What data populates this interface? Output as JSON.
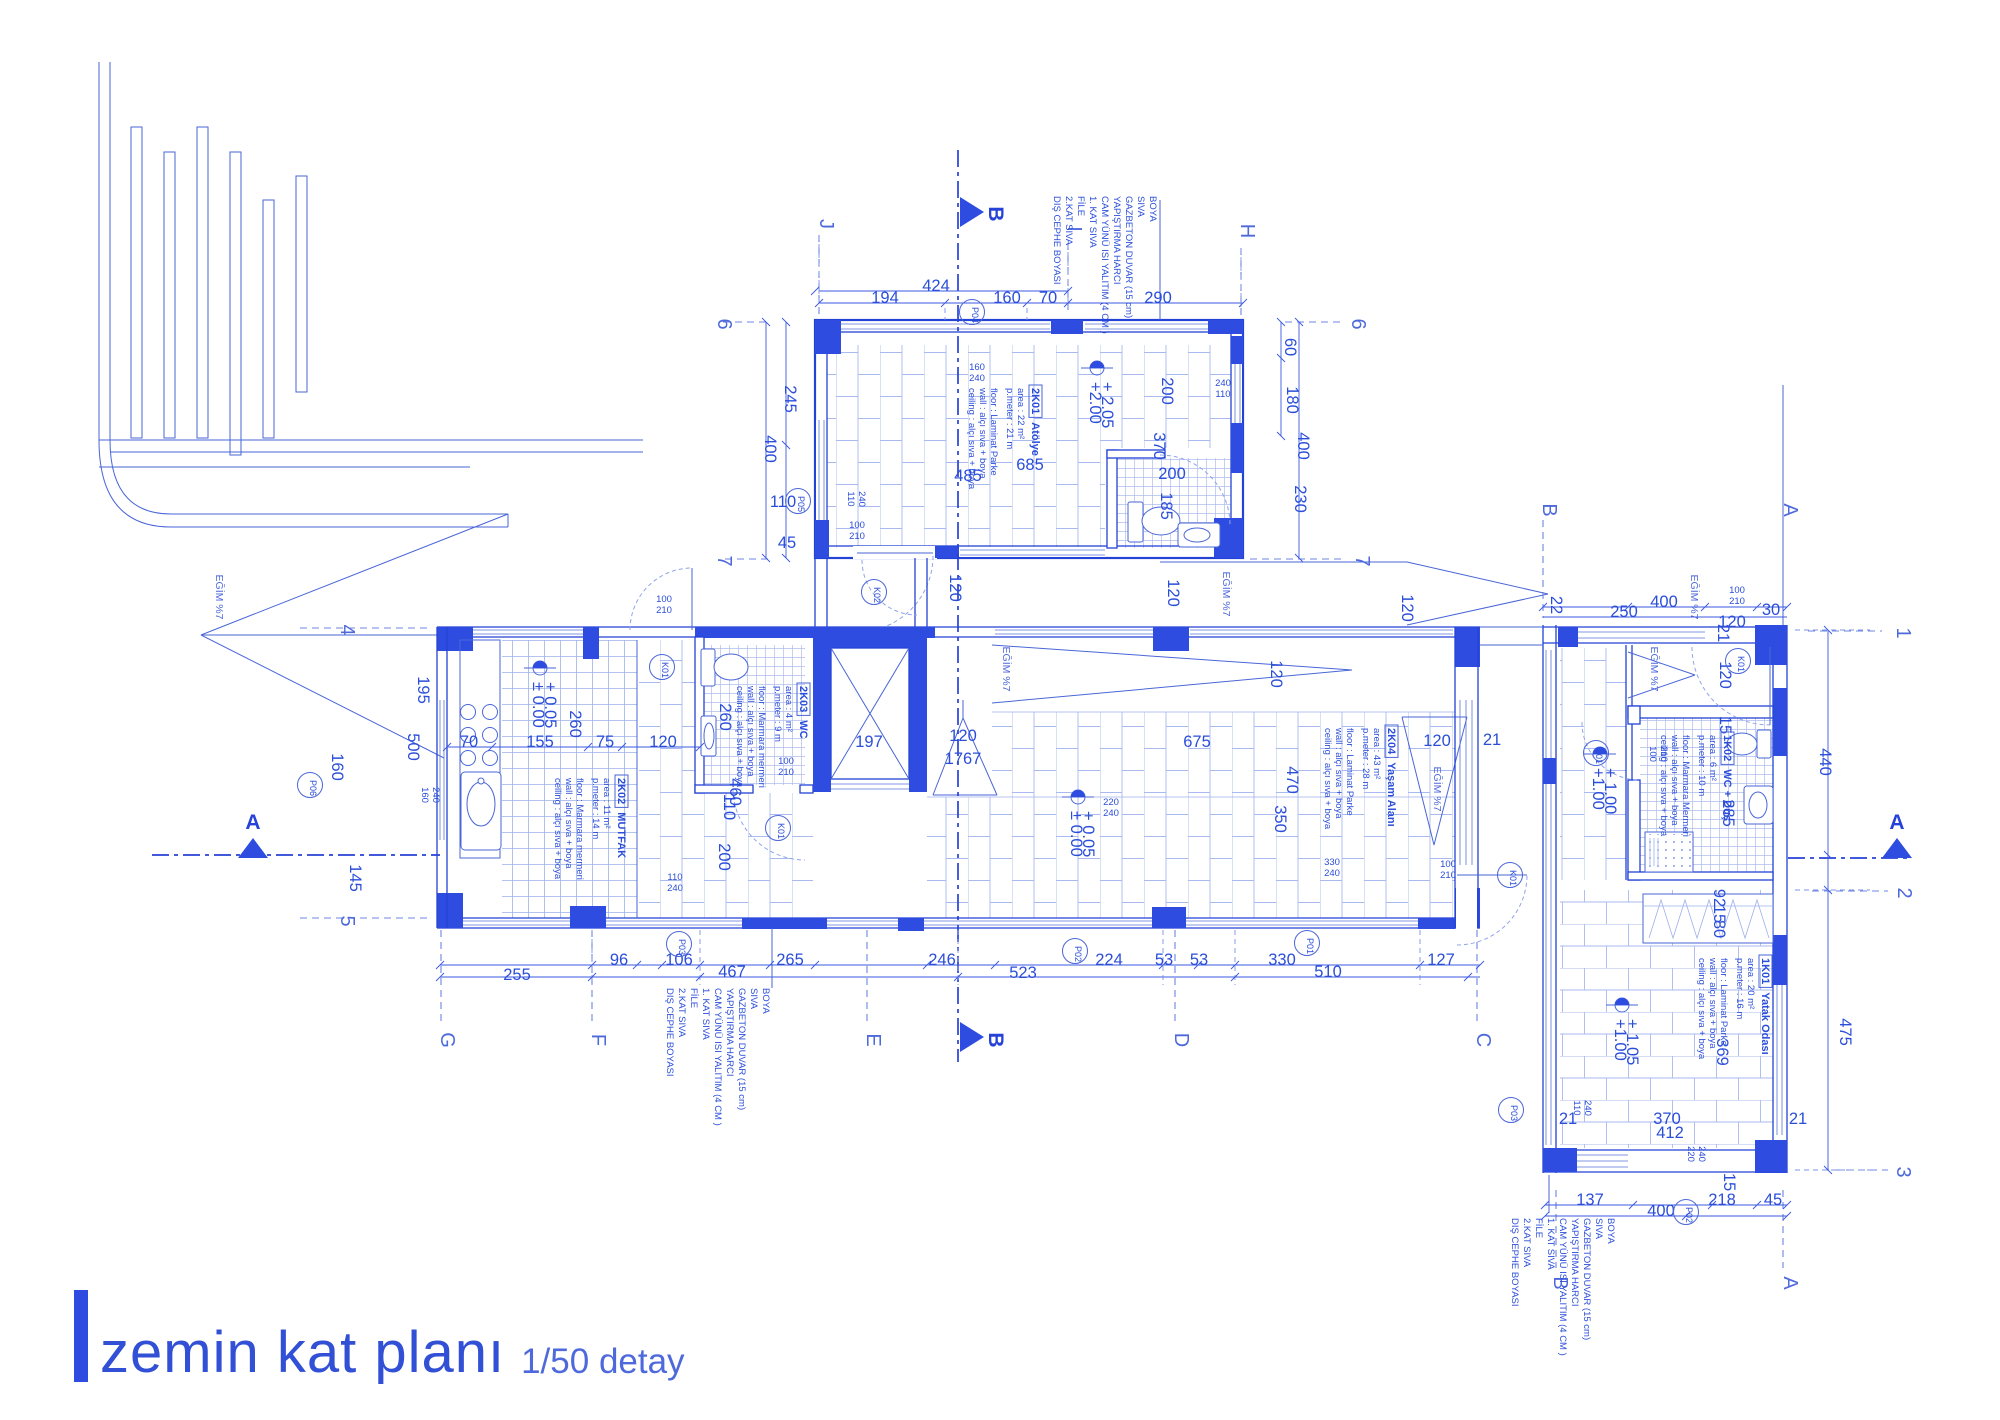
{
  "title": {
    "main": "zemin kat planı",
    "scale": "1/50 detay"
  },
  "colors": {
    "ink": "#2b4ed9",
    "wall": "#2442d6",
    "column": "#2e4de0",
    "light": "#9db0ec"
  },
  "note_lines": [
    "BOYA",
    "SIVA",
    "GAZBETON DUVAR (15 cm)",
    "YAPIŞTIRMA HARCI",
    "CAM YÜNÜ ISI YALITIM (4 CM )",
    "1. KAT SIVA",
    "FİLE",
    "2.KAT SIVA",
    "DIŞ CEPHE BOYASI"
  ],
  "notes": [
    {
      "x": 1150,
      "y": 196
    },
    {
      "x": 763,
      "y": 988
    },
    {
      "x": 1608,
      "y": 1218
    }
  ],
  "rooms": [
    {
      "code": "2K01",
      "name": "Atölye",
      "x": 1032,
      "y": 388,
      "lines": [
        "area : 22 m²",
        "p.meter : 21 m",
        "floor : Laminat Parke",
        "wall : alçı sıva + boya",
        "ceiling : alçı sıva + boya"
      ]
    },
    {
      "code": "2K02",
      "name": "MUTFAK",
      "x": 618,
      "y": 778,
      "lines": [
        "area : 11 m²",
        "p.meter : 14 m",
        "floor : Marmara mermeri",
        "wall : alçı sıva + boya",
        "ceiling : alçı sıva + boya"
      ]
    },
    {
      "code": "2K03",
      "name": "WC",
      "x": 800,
      "y": 686,
      "lines": [
        "area : 4 m²",
        "p.meter : 9 m",
        "floor : Marmara mermeri",
        "wall : alçı sıva + boya",
        "ceiling : alçı sıva + boya"
      ]
    },
    {
      "code": "2K04",
      "name": "Yaşam Alanı",
      "x": 1388,
      "y": 728,
      "lines": [
        "area : 43 m²",
        "p.meter : 28 m",
        "floor : Laminat Parke",
        "wall : alçı sıva + boya",
        "ceiling : alçı sıva + boya"
      ]
    },
    {
      "code": "1K02",
      "name": "WC + Duş",
      "x": 1724,
      "y": 735,
      "lines": [
        "area : 6 m²",
        "p.meter : 10 m",
        "floor : Marmara Mermeri",
        "wall : alçı sıva + boya",
        "ceiling : alçı sıva + boya"
      ]
    },
    {
      "code": "1K01",
      "name": "Yatak Odası",
      "x": 1762,
      "y": 958,
      "lines": [
        "area : 20 m²",
        "p.meter : 16 m",
        "floor : Laminat Parke",
        "wall : alçı sıva + boya",
        "ceiling : alçı sıva + boya"
      ]
    }
  ],
  "tags": [
    {
      "t": "P04",
      "x": 972,
      "y": 312
    },
    {
      "t": "P05",
      "x": 798,
      "y": 501
    },
    {
      "t": "K02",
      "x": 874,
      "y": 592
    },
    {
      "t": "K01",
      "x": 662,
      "y": 667
    },
    {
      "t": "K01",
      "x": 778,
      "y": 828
    },
    {
      "t": "P06",
      "x": 310,
      "y": 785
    },
    {
      "t": "P03",
      "x": 679,
      "y": 944
    },
    {
      "t": "P02",
      "x": 1075,
      "y": 951
    },
    {
      "t": "P01",
      "x": 1307,
      "y": 943
    },
    {
      "t": "K01",
      "x": 1510,
      "y": 875
    },
    {
      "t": "K01",
      "x": 1738,
      "y": 661
    },
    {
      "t": "K01",
      "x": 1596,
      "y": 753
    },
    {
      "t": "P03",
      "x": 1511,
      "y": 1110
    },
    {
      "t": "P02",
      "x": 1686,
      "y": 1212
    }
  ],
  "elevations": [
    {
      "x": 1097,
      "y": 368,
      "l1": "+ 2.05",
      "l2": "+2.00"
    },
    {
      "x": 540,
      "y": 668,
      "l1": "+ 0.05",
      "l2": "± 0.00"
    },
    {
      "x": 1078,
      "y": 797,
      "l1": "+ 0.05",
      "l2": "± 0.00"
    },
    {
      "x": 1600,
      "y": 754,
      "l1": "+ 1.00",
      "l2": "+1.00"
    },
    {
      "x": 1622,
      "y": 1005,
      "l1": "+ 1.05",
      "l2": "+1.00"
    }
  ],
  "labels": [
    {
      "t": "424",
      "x": 936,
      "y": 291
    },
    {
      "t": "194",
      "x": 885,
      "y": 303
    },
    {
      "t": "160",
      "x": 1007,
      "y": 303
    },
    {
      "t": "70",
      "x": 1048,
      "y": 303
    },
    {
      "t": "290",
      "x": 1158,
      "y": 303
    },
    {
      "t": "485",
      "x": 968,
      "y": 481
    },
    {
      "t": "685",
      "x": 1030,
      "y": 470
    },
    {
      "t": "200",
      "x": 1162,
      "y": 391,
      "r": 1
    },
    {
      "t": "370",
      "x": 1154,
      "y": 446,
      "r": 1
    },
    {
      "t": "200",
      "x": 1172,
      "y": 479
    },
    {
      "t": "185",
      "x": 1161,
      "y": 506,
      "r": 1
    },
    {
      "t": "245",
      "x": 785,
      "y": 399,
      "r": 1
    },
    {
      "t": "400",
      "x": 765,
      "y": 449,
      "r": 1
    },
    {
      "t": "110",
      "x": 783,
      "y": 507
    },
    {
      "t": "45",
      "x": 787,
      "y": 548
    },
    {
      "t": "60",
      "x": 1285,
      "y": 347,
      "r": 1
    },
    {
      "t": "180",
      "x": 1287,
      "y": 400,
      "r": 1
    },
    {
      "t": "400",
      "x": 1298,
      "y": 446,
      "r": 1
    },
    {
      "t": "230",
      "x": 1295,
      "y": 499,
      "r": 1
    },
    {
      "t": "120",
      "x": 950,
      "y": 588,
      "r": 1
    },
    {
      "t": "120",
      "x": 1168,
      "y": 593,
      "r": 1
    },
    {
      "t": "120",
      "x": 1402,
      "y": 608,
      "r": 1
    },
    {
      "t": "195",
      "x": 418,
      "y": 690,
      "r": 1
    },
    {
      "t": "500",
      "x": 408,
      "y": 747,
      "r": 1
    },
    {
      "t": "160",
      "x": 332,
      "y": 767,
      "r": 1
    },
    {
      "t": "145",
      "x": 350,
      "y": 878,
      "r": 1
    },
    {
      "t": "70",
      "x": 469,
      "y": 747
    },
    {
      "t": "155",
      "x": 540,
      "y": 747
    },
    {
      "t": "75",
      "x": 605,
      "y": 747
    },
    {
      "t": "120",
      "x": 663,
      "y": 747
    },
    {
      "t": "260",
      "x": 570,
      "y": 724,
      "r": 1
    },
    {
      "t": "260",
      "x": 720,
      "y": 717,
      "r": 1
    },
    {
      "t": "460",
      "x": 730,
      "y": 792,
      "r": 1
    },
    {
      "t": "110",
      "x": 724,
      "y": 807,
      "r": 1
    },
    {
      "t": "200",
      "x": 719,
      "y": 857,
      "r": 1
    },
    {
      "t": "197",
      "x": 869,
      "y": 747
    },
    {
      "t": "120",
      "x": 963,
      "y": 741
    },
    {
      "t": "1767",
      "x": 963,
      "y": 764
    },
    {
      "t": "675",
      "x": 1197,
      "y": 747
    },
    {
      "t": "120",
      "x": 1271,
      "y": 674,
      "r": 1
    },
    {
      "t": "470",
      "x": 1287,
      "y": 780,
      "r": 1
    },
    {
      "t": "350",
      "x": 1275,
      "y": 819,
      "r": 1
    },
    {
      "t": "120",
      "x": 1437,
      "y": 746
    },
    {
      "t": "21",
      "x": 1492,
      "y": 745
    },
    {
      "t": "255",
      "x": 517,
      "y": 980
    },
    {
      "t": "96",
      "x": 619,
      "y": 965
    },
    {
      "t": "106",
      "x": 679,
      "y": 965
    },
    {
      "t": "467",
      "x": 732,
      "y": 977
    },
    {
      "t": "265",
      "x": 790,
      "y": 965
    },
    {
      "t": "246",
      "x": 942,
      "y": 965
    },
    {
      "t": "523",
      "x": 1023,
      "y": 978
    },
    {
      "t": "224",
      "x": 1109,
      "y": 965
    },
    {
      "t": "53",
      "x": 1164,
      "y": 965
    },
    {
      "t": "53",
      "x": 1199,
      "y": 965
    },
    {
      "t": "330",
      "x": 1282,
      "y": 965
    },
    {
      "t": "510",
      "x": 1328,
      "y": 977
    },
    {
      "t": "127",
      "x": 1441,
      "y": 965
    },
    {
      "t": "400",
      "x": 1664,
      "y": 607
    },
    {
      "t": "250",
      "x": 1624,
      "y": 617
    },
    {
      "t": "120",
      "x": 1732,
      "y": 627
    },
    {
      "t": "30",
      "x": 1771,
      "y": 615
    },
    {
      "t": "22",
      "x": 1551,
      "y": 605,
      "r": 1,
      "fs": 13
    },
    {
      "t": "21",
      "x": 1718,
      "y": 633,
      "r": 1,
      "fs": 13
    },
    {
      "t": "120",
      "x": 1720,
      "y": 675,
      "r": 1
    },
    {
      "t": "15",
      "x": 1720,
      "y": 725,
      "r": 1,
      "fs": 13
    },
    {
      "t": "285",
      "x": 1723,
      "y": 813,
      "r": 1
    },
    {
      "t": "92",
      "x": 1714,
      "y": 898,
      "r": 1,
      "fs": 12
    },
    {
      "t": "15",
      "x": 1714,
      "y": 914,
      "r": 1,
      "fs": 12
    },
    {
      "t": "80",
      "x": 1714,
      "y": 929,
      "r": 1,
      "fs": 12
    },
    {
      "t": "369",
      "x": 1717,
      "y": 1052,
      "r": 1
    },
    {
      "t": "370",
      "x": 1667,
      "y": 1124
    },
    {
      "t": "412",
      "x": 1670,
      "y": 1138
    },
    {
      "t": "21",
      "x": 1798,
      "y": 1124,
      "fs": 13
    },
    {
      "t": "21",
      "x": 1568,
      "y": 1124,
      "fs": 13
    },
    {
      "t": "137",
      "x": 1590,
      "y": 1205
    },
    {
      "t": "400",
      "x": 1661,
      "y": 1216
    },
    {
      "t": "218",
      "x": 1722,
      "y": 1205
    },
    {
      "t": "45",
      "x": 1773,
      "y": 1205
    },
    {
      "t": "15",
      "x": 1724,
      "y": 1182,
      "r": 1,
      "fs": 13
    },
    {
      "t": "440",
      "x": 1820,
      "y": 762,
      "r": 1
    },
    {
      "t": "475",
      "x": 1840,
      "y": 1032,
      "r": 1
    },
    {
      "t": "100",
      "x": 857,
      "y": 528,
      "c": "s"
    },
    {
      "t": "210",
      "x": 857,
      "y": 539,
      "c": "s"
    },
    {
      "t": "100",
      "x": 664,
      "y": 602,
      "c": "s"
    },
    {
      "t": "210",
      "x": 664,
      "y": 613,
      "c": "s"
    },
    {
      "t": "100",
      "x": 786,
      "y": 764,
      "c": "s"
    },
    {
      "t": "210",
      "x": 786,
      "y": 775,
      "c": "s"
    },
    {
      "t": "100",
      "x": 1448,
      "y": 867,
      "c": "s"
    },
    {
      "t": "210",
      "x": 1448,
      "y": 878,
      "c": "s"
    },
    {
      "t": "100",
      "x": 1737,
      "y": 593,
      "c": "s"
    },
    {
      "t": "210",
      "x": 1737,
      "y": 604,
      "c": "s"
    },
    {
      "t": "100",
      "x": 1650,
      "y": 754,
      "c": "s",
      "r": 1
    },
    {
      "t": "210",
      "x": 1661,
      "y": 754,
      "c": "s",
      "r": 1
    },
    {
      "t": "160",
      "x": 977,
      "y": 370,
      "c": "s"
    },
    {
      "t": "240",
      "x": 977,
      "y": 381,
      "c": "s"
    },
    {
      "t": "110",
      "x": 848,
      "y": 499,
      "c": "s",
      "r": 1
    },
    {
      "t": "240",
      "x": 859,
      "y": 499,
      "c": "s",
      "r": 1
    },
    {
      "t": "240",
      "x": 1223,
      "y": 386,
      "c": "s"
    },
    {
      "t": "110",
      "x": 1223,
      "y": 397,
      "c": "s"
    },
    {
      "t": "160",
      "x": 422,
      "y": 795,
      "c": "s",
      "r": 1
    },
    {
      "t": "240",
      "x": 433,
      "y": 795,
      "c": "s",
      "r": 1
    },
    {
      "t": "110",
      "x": 675,
      "y": 880,
      "c": "s"
    },
    {
      "t": "240",
      "x": 675,
      "y": 891,
      "c": "s"
    },
    {
      "t": "220",
      "x": 1111,
      "y": 805,
      "c": "s"
    },
    {
      "t": "240",
      "x": 1111,
      "y": 816,
      "c": "s"
    },
    {
      "t": "330",
      "x": 1332,
      "y": 865,
      "c": "s"
    },
    {
      "t": "240",
      "x": 1332,
      "y": 876,
      "c": "s"
    },
    {
      "t": "110",
      "x": 1574,
      "y": 1108,
      "c": "s",
      "r": 1
    },
    {
      "t": "240",
      "x": 1585,
      "y": 1108,
      "c": "s",
      "r": 1
    },
    {
      "t": "220",
      "x": 1688,
      "y": 1154,
      "c": "s",
      "r": 1
    },
    {
      "t": "240",
      "x": 1699,
      "y": 1154,
      "c": "s",
      "r": 1
    },
    {
      "t": "EĞİM %7",
      "x": 216,
      "y": 597,
      "c": "e",
      "r": 1
    },
    {
      "t": "EĞİM %7",
      "x": 1003,
      "y": 669,
      "c": "e",
      "r": 1
    },
    {
      "t": "EĞİM %7",
      "x": 1223,
      "y": 594,
      "c": "e",
      "r": 1
    },
    {
      "t": "EĞİM %7",
      "x": 1434,
      "y": 789,
      "c": "e",
      "r": 1
    },
    {
      "t": "EĞİM %7",
      "x": 1651,
      "y": 669,
      "c": "e",
      "r": 1
    },
    {
      "t": "EĞİM %7",
      "x": 1691,
      "y": 597,
      "c": "e",
      "r": 1
    },
    {
      "t": "J",
      "x": 820,
      "y": 224,
      "c": "g",
      "r": 1
    },
    {
      "t": "I",
      "x": 1068,
      "y": 229,
      "c": "g",
      "r": 1
    },
    {
      "t": "H",
      "x": 1241,
      "y": 231,
      "c": "g",
      "r": 1
    },
    {
      "t": "G",
      "x": 441,
      "y": 1040,
      "c": "g",
      "r": 1
    },
    {
      "t": "F",
      "x": 592,
      "y": 1040,
      "c": "g",
      "r": 1
    },
    {
      "t": "E",
      "x": 867,
      "y": 1040,
      "c": "g",
      "r": 1
    },
    {
      "t": "D",
      "x": 1175,
      "y": 1040,
      "c": "g",
      "r": 1
    },
    {
      "t": "C",
      "x": 1477,
      "y": 1040,
      "c": "g",
      "r": 1
    },
    {
      "t": "6",
      "x": 718,
      "y": 324,
      "c": "g",
      "r": 1
    },
    {
      "t": "6",
      "x": 1352,
      "y": 324,
      "c": "g",
      "r": 1
    },
    {
      "t": "7",
      "x": 718,
      "y": 561,
      "c": "g",
      "r": 1
    },
    {
      "t": "7",
      "x": 1356,
      "y": 561,
      "c": "g",
      "r": 1
    },
    {
      "t": "4",
      "x": 341,
      "y": 630,
      "c": "g",
      "r": 1
    },
    {
      "t": "5",
      "x": 341,
      "y": 921,
      "c": "g",
      "r": 1
    },
    {
      "t": "1",
      "x": 1897,
      "y": 633,
      "c": "g",
      "r": 1
    },
    {
      "t": "2",
      "x": 1898,
      "y": 893,
      "c": "g",
      "r": 1
    },
    {
      "t": "3",
      "x": 1897,
      "y": 1172,
      "c": "g",
      "r": 1
    },
    {
      "t": "B",
      "x": 1543,
      "y": 510,
      "c": "g",
      "r": 1
    },
    {
      "t": "A",
      "x": 1784,
      "y": 510,
      "c": "g",
      "r": 1
    },
    {
      "t": "B",
      "x": 1554,
      "y": 1283,
      "c": "g",
      "r": 1
    },
    {
      "t": "A",
      "x": 1784,
      "y": 1283,
      "c": "g",
      "r": 1
    },
    {
      "t": "B",
      "x": 989,
      "y": 214,
      "c": "x",
      "r": 1
    },
    {
      "t": "B",
      "x": 989,
      "y": 1040,
      "c": "x",
      "r": 1
    },
    {
      "t": "A",
      "x": 253,
      "y": 829,
      "c": "x"
    },
    {
      "t": "A",
      "x": 1897,
      "y": 829,
      "c": "x"
    }
  ]
}
